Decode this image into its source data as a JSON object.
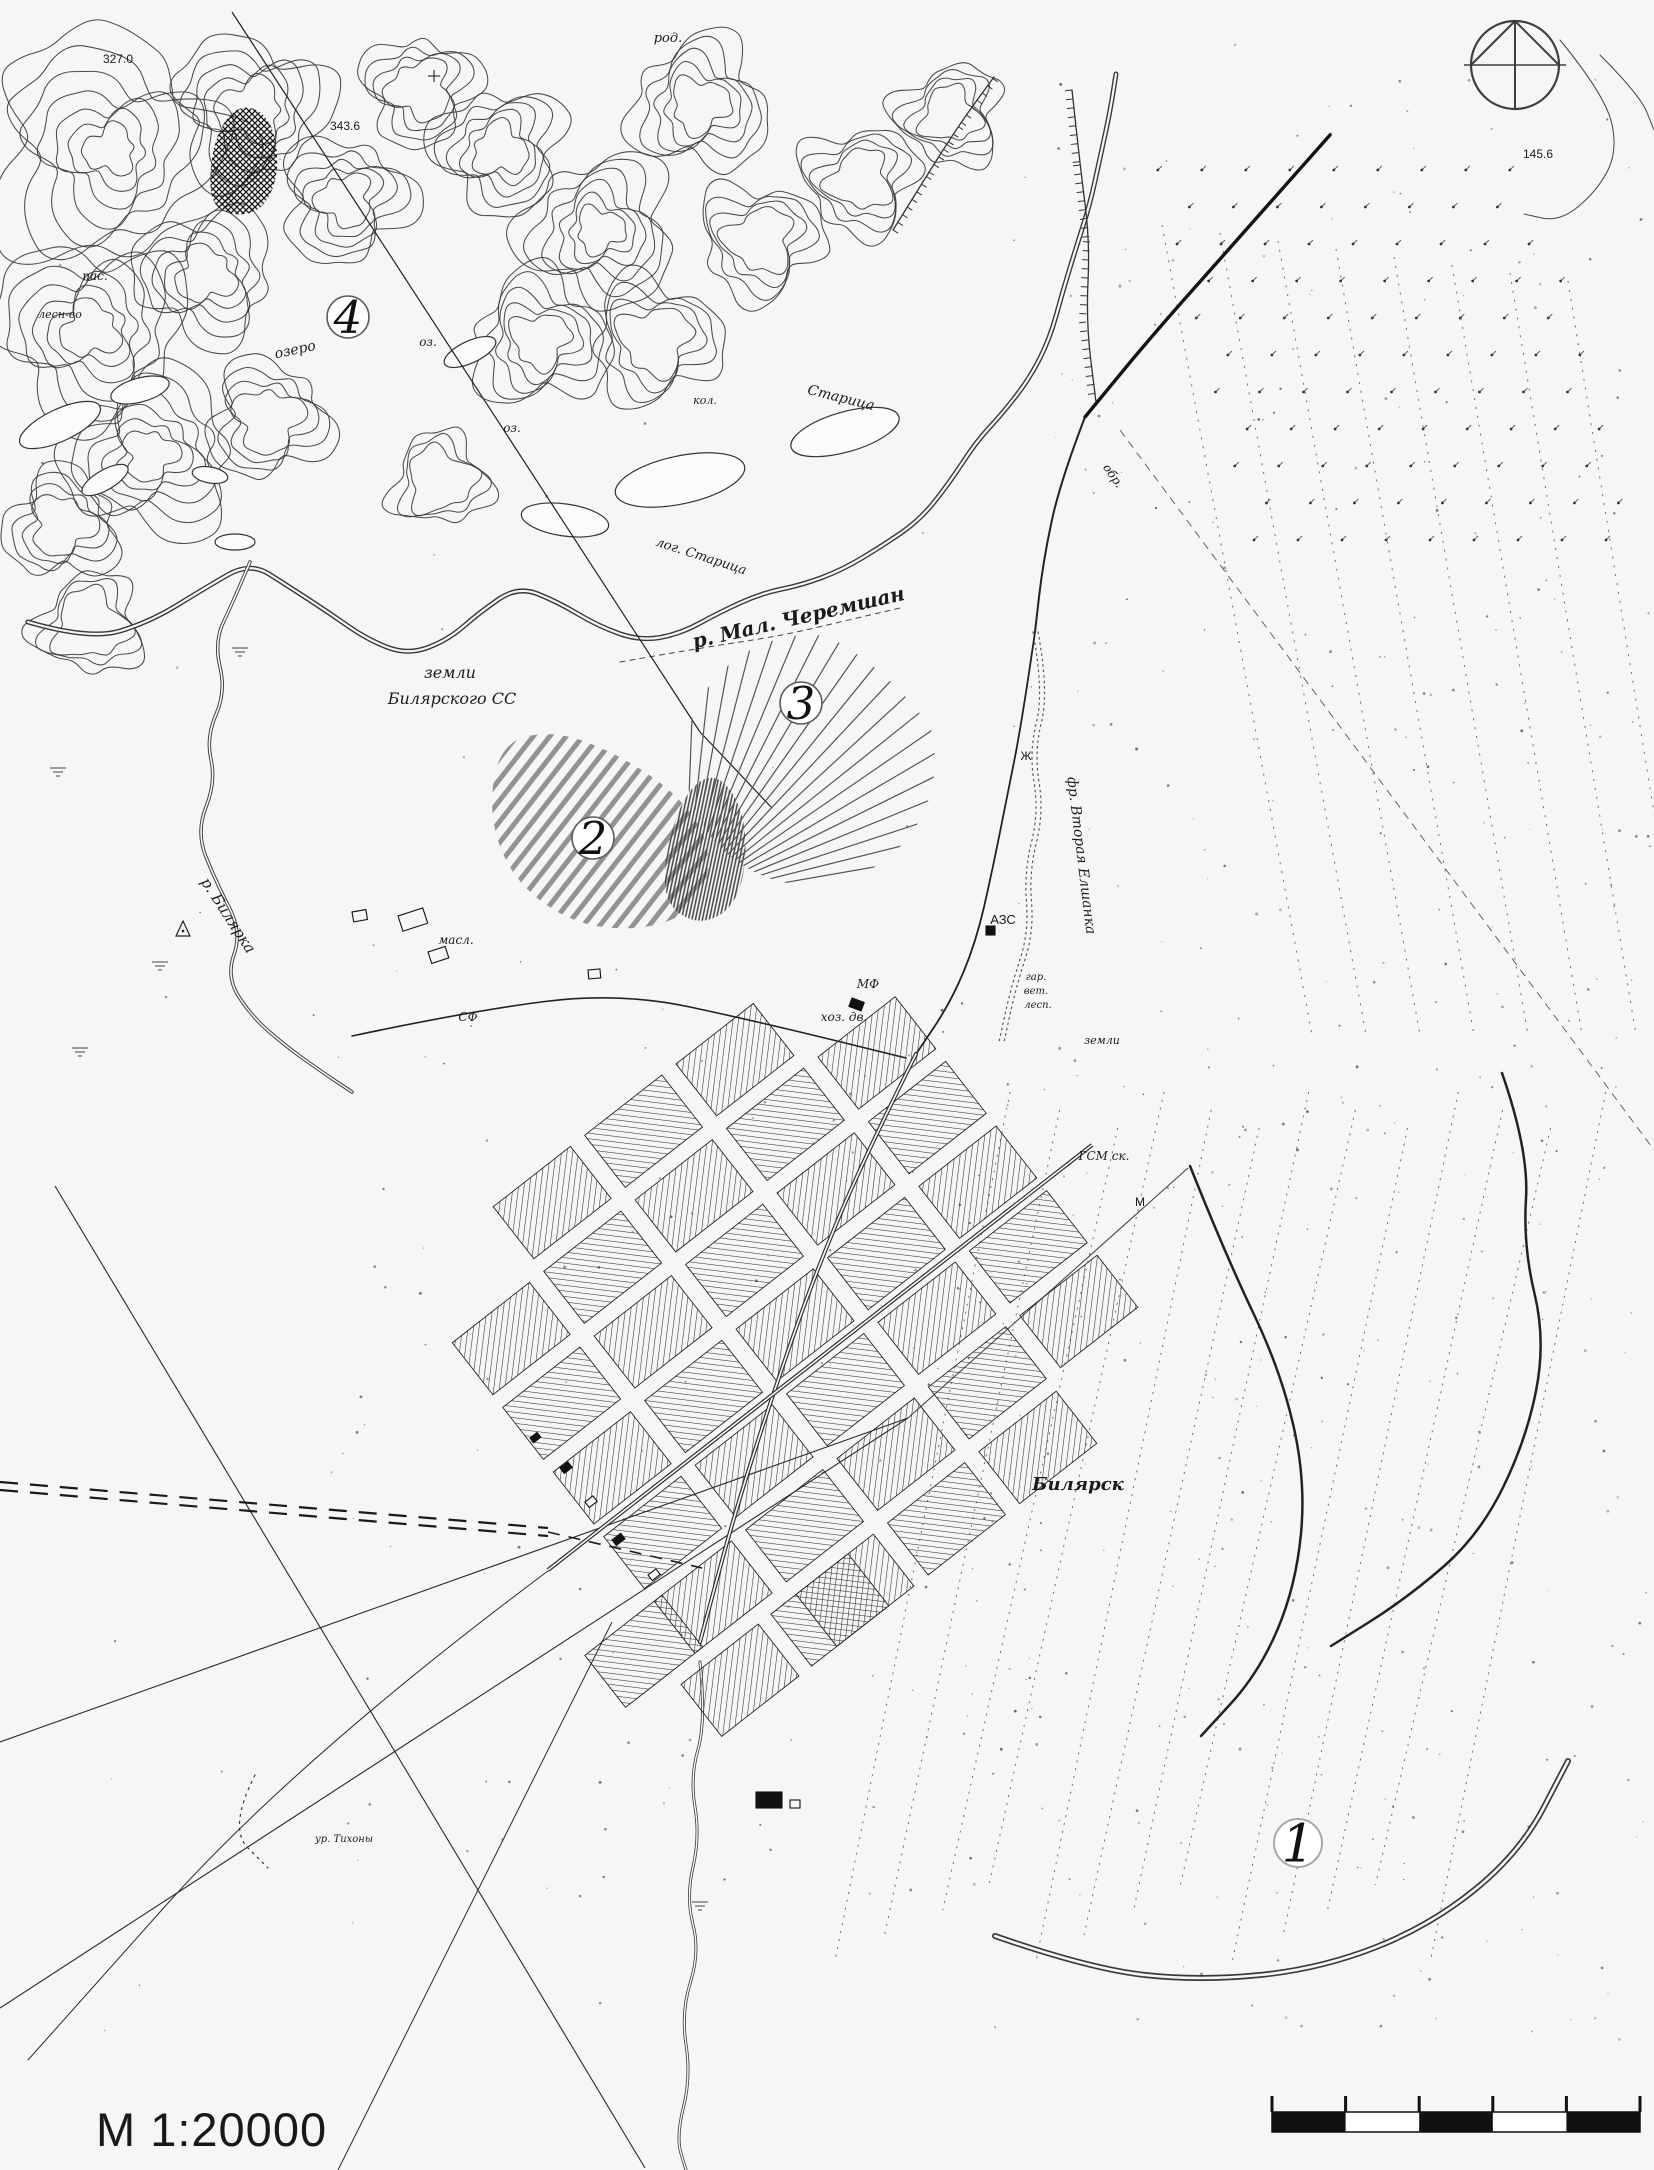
{
  "page": {
    "scale_label": "М 1:20000"
  },
  "compass": {
    "cx": 1515,
    "cy": 65,
    "r": 44
  },
  "scale_bar": {
    "x": 1272,
    "y": 2112,
    "width": 368,
    "height": 20,
    "segments": 5,
    "tick_height": 16,
    "color": "#111111"
  },
  "markers": [
    {
      "id": "1",
      "x": 1298,
      "y": 1843,
      "r": 24,
      "ring": "#a8a8a8"
    },
    {
      "id": "2",
      "x": 593,
      "y": 838,
      "r": 21,
      "ring": "#5a5a5a"
    },
    {
      "id": "3",
      "x": 801,
      "y": 703,
      "r": 21,
      "ring": "#5a5a5a"
    },
    {
      "id": "4",
      "x": 348,
      "y": 317,
      "r": 21,
      "ring": "#5a5a5a"
    }
  ],
  "labels": [
    {
      "t": "327.0",
      "x": 118,
      "y": 63,
      "r": 0,
      "s": 12,
      "i": 0
    },
    {
      "t": "343.6",
      "x": 345,
      "y": 130,
      "r": 0,
      "s": 12,
      "i": 0
    },
    {
      "t": "145.6",
      "x": 1538,
      "y": 158,
      "r": 0,
      "s": 12,
      "i": 0
    },
    {
      "t": "род.",
      "x": 668,
      "y": 42,
      "r": 0,
      "s": 13
    },
    {
      "t": "пас.",
      "x": 95,
      "y": 280,
      "r": 0,
      "s": 12
    },
    {
      "t": "лесн-во",
      "x": 60,
      "y": 318,
      "r": 0,
      "s": 11
    },
    {
      "t": "озеро",
      "x": 296,
      "y": 354,
      "r": -12,
      "s": 14
    },
    {
      "t": "оз.",
      "x": 428,
      "y": 346,
      "r": 0,
      "s": 12
    },
    {
      "t": "оз.",
      "x": 512,
      "y": 432,
      "r": 0,
      "s": 12
    },
    {
      "t": "кол.",
      "x": 705,
      "y": 404,
      "r": 0,
      "s": 11
    },
    {
      "t": "Старица",
      "x": 840,
      "y": 402,
      "r": 14,
      "s": 14
    },
    {
      "t": "лог. Старица",
      "x": 700,
      "y": 560,
      "r": 18,
      "s": 13
    },
    {
      "t": "р. Мал. Черемшан",
      "x": 800,
      "y": 624,
      "r": -13,
      "s": 20,
      "w": 600
    },
    {
      "t": "земли",
      "x": 450,
      "y": 678,
      "r": 0,
      "s": 16
    },
    {
      "t": "Билярского СС",
      "x": 452,
      "y": 704,
      "r": 0,
      "s": 16
    },
    {
      "t": "обр.",
      "x": 1110,
      "y": 478,
      "r": 55,
      "s": 12
    },
    {
      "t": "фр. Вторая Елшанка",
      "x": 1077,
      "y": 856,
      "r": 83,
      "s": 14
    },
    {
      "t": "Ж",
      "x": 1026,
      "y": 760,
      "r": 0,
      "s": 12,
      "i": 0
    },
    {
      "t": "р. Билярка",
      "x": 224,
      "y": 918,
      "r": 57,
      "s": 15
    },
    {
      "t": "АЗС",
      "x": 1003,
      "y": 924,
      "r": 0,
      "s": 13,
      "i": 0
    },
    {
      "t": "масл.",
      "x": 456,
      "y": 944,
      "r": 0,
      "s": 12
    },
    {
      "t": "СФ",
      "x": 468,
      "y": 1021,
      "r": 0,
      "s": 12
    },
    {
      "t": "МФ",
      "x": 868,
      "y": 988,
      "r": 0,
      "s": 12
    },
    {
      "t": "хоз. дв.",
      "x": 844,
      "y": 1021,
      "r": 0,
      "s": 12
    },
    {
      "t": "гар.",
      "x": 1036,
      "y": 980,
      "r": 0,
      "s": 10
    },
    {
      "t": "вет.",
      "x": 1036,
      "y": 994,
      "r": 0,
      "s": 10
    },
    {
      "t": "лесп.",
      "x": 1038,
      "y": 1008,
      "r": 0,
      "s": 10
    },
    {
      "t": "земли",
      "x": 1102,
      "y": 1044,
      "r": 0,
      "s": 11
    },
    {
      "t": "ГСМ ск.",
      "x": 1104,
      "y": 1160,
      "r": 0,
      "s": 12
    },
    {
      "t": "М",
      "x": 1140,
      "y": 1206,
      "r": 0,
      "s": 12,
      "i": 0
    },
    {
      "t": "Билярск",
      "x": 1078,
      "y": 1490,
      "r": 0,
      "s": 18,
      "w": 600
    },
    {
      "t": "ур. Тихоны",
      "x": 344,
      "y": 1842,
      "r": 0,
      "s": 10
    }
  ]
}
